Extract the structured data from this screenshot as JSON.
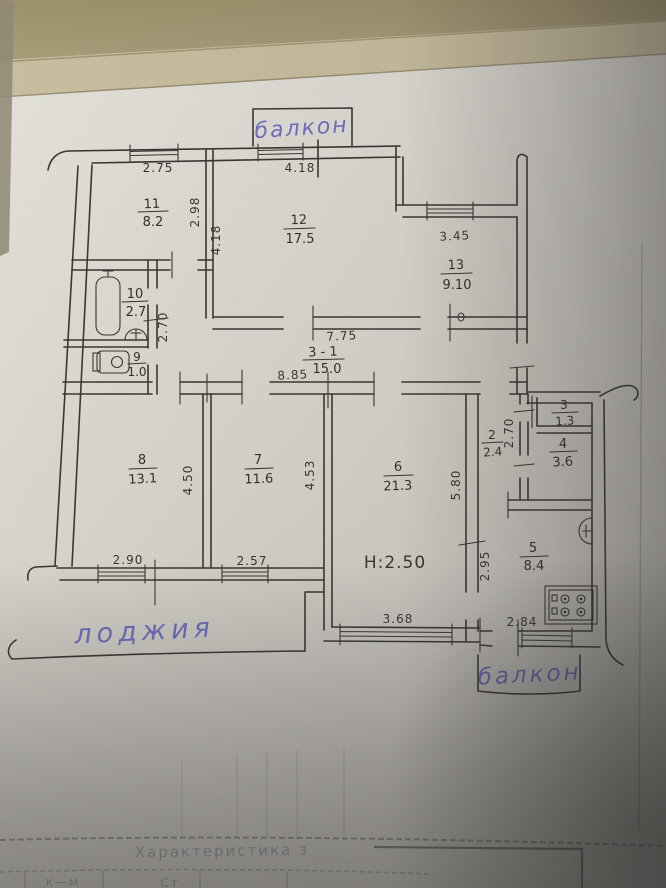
{
  "photo": {
    "table_color": "#a89b78",
    "paper_color": "#d8d4cd",
    "ink_color": "#3a3733",
    "pen_color": "#5e62bd"
  },
  "labels": {
    "balcony_top": "балкон",
    "balcony_bottom": "балкон",
    "loggia": "лоджия",
    "ceiling_height": "H:2.50"
  },
  "rooms": {
    "r11": {
      "number": "11",
      "area": "8.2"
    },
    "r12": {
      "number": "12",
      "area": "17.5"
    },
    "r13": {
      "number": "13",
      "area": "9.10"
    },
    "r10": {
      "number": "10",
      "area": "2.7"
    },
    "r9": {
      "number": "9",
      "area": "1.0"
    },
    "r31": {
      "number": "3 - 1",
      "area": "15.0"
    },
    "r8": {
      "number": "8",
      "area": "13.1"
    },
    "r7": {
      "number": "7",
      "area": "11.6"
    },
    "r6": {
      "number": "6",
      "area": "21.3"
    },
    "r2": {
      "number": "2",
      "area": "2.4"
    },
    "r3": {
      "number": "3",
      "area": "1.3"
    },
    "r4": {
      "number": "4",
      "area": "3.6"
    },
    "r5": {
      "number": "5",
      "area": "8.4"
    }
  },
  "dimensions": {
    "room11_width": "2.75",
    "room12_width": "4.18",
    "room13_width": "3.45",
    "room11_depth": "2.98",
    "room12_depth": "4.18",
    "bath_depth": "2.70",
    "corridor_upper": "7.75",
    "corridor_lower": "8.85",
    "room8_depth": "4.50",
    "room7_depth": "4.53",
    "room6_depth": "5.80",
    "hall2_depth": "2.70",
    "kitchen_depth": "2.95",
    "room8_window": "2.90",
    "room7_window": "2.57",
    "room6_window": "3.68",
    "kitchen_window": "2.84"
  },
  "footer": {
    "stamp_text": "Характеристика з",
    "cell_a": "к—м",
    "cell_b": "Ст"
  }
}
